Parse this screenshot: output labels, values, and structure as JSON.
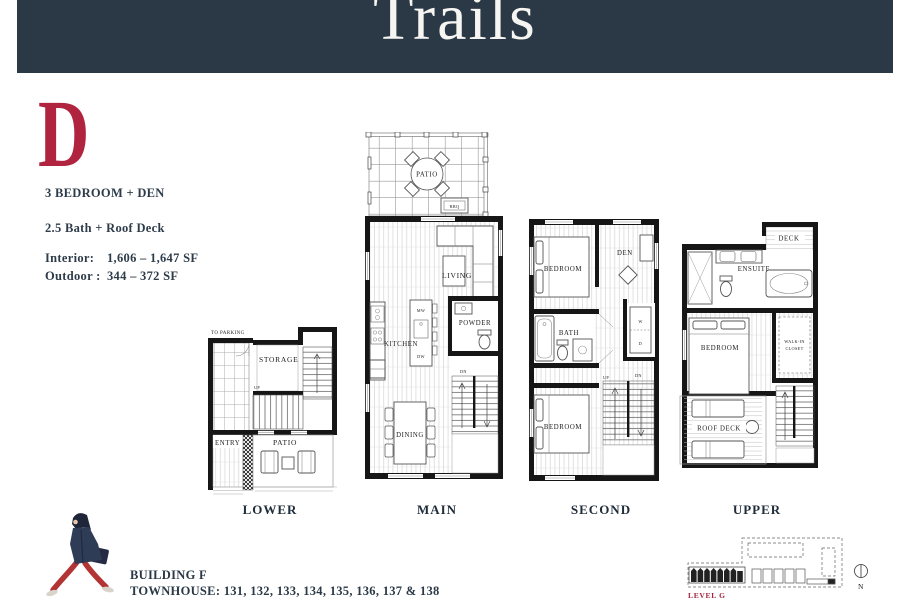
{
  "header": {
    "title": "Trails"
  },
  "unit": {
    "letter": "D",
    "line1": "3 BEDROOM + DEN",
    "line2": "2.5 Bath + Roof Deck",
    "interior_label": "Interior:",
    "interior_value": "1,606 – 1,647 SF",
    "outdoor_label": "Outdoor :",
    "outdoor_value": "344 – 372 SF"
  },
  "plans": [
    {
      "name": "LOWER",
      "labels": {
        "to_parking": "TO PARKING",
        "storage": "STORAGE",
        "up": "UP",
        "entry": "ENTRY",
        "patio": "PATIO"
      }
    },
    {
      "name": "MAIN",
      "labels": {
        "patio": "PATIO",
        "bbq": "BBQ",
        "living": "LIVING",
        "kitchen": "KITCHEN",
        "mw": "MW",
        "dw": "DW",
        "powder": "POWDER",
        "dn": "DN",
        "dining": "DINING"
      }
    },
    {
      "name": "SECOND",
      "labels": {
        "bedroom1": "BEDROOM",
        "den": "DEN",
        "bath": "BATH",
        "w": "W",
        "d": "D",
        "up": "UP",
        "dn": "DN",
        "bedroom2": "BEDROOM"
      }
    },
    {
      "name": "UPPER",
      "labels": {
        "deck": "DECK",
        "ensuite": "ENSUITE",
        "walkin_line1": "WALK-IN",
        "walkin_line2": "CLOSET",
        "bedroom": "BEDROOM",
        "roof_deck": "ROOF DECK"
      }
    }
  ],
  "footer": {
    "building": "BUILDING F",
    "townhouse": "TOWNHOUSE: 131, 132, 133, 134, 135, 136, 137 & 138"
  },
  "siteplan": {
    "level": "LEVEL G",
    "north": "N"
  },
  "colors": {
    "navy": "#2b3947",
    "crimson": "#b0243f",
    "site_red": "#a5233d"
  }
}
